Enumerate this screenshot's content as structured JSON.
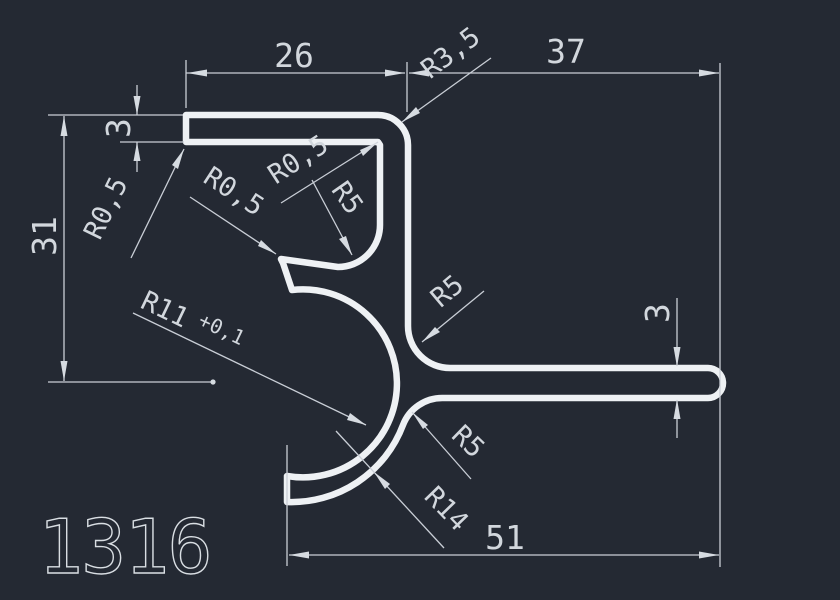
{
  "drawing": {
    "part_number": "1316",
    "dims": {
      "top_left_width": "26",
      "top_right_width": "37",
      "left_height": "31",
      "flange_thickness": "3",
      "arm_thickness": "3",
      "bottom_width": "51"
    },
    "radii": {
      "corner_top_right": "R3,5",
      "inner_top_corner": "R0,5",
      "inner_fillet": "R5",
      "lip_corner": "R0,5",
      "flange_end_corner": "R0,5",
      "bore_radius": "R11",
      "bore_tolerance": "+0,1",
      "stem_arm_fillet": "R5",
      "arm_arc_fillet": "R5",
      "outer_arc": "R14"
    },
    "colors": {
      "background": "#242933",
      "outline": "#eef1f4",
      "dimension_lines": "#c9ced6",
      "text": "#d2d7dd"
    }
  }
}
